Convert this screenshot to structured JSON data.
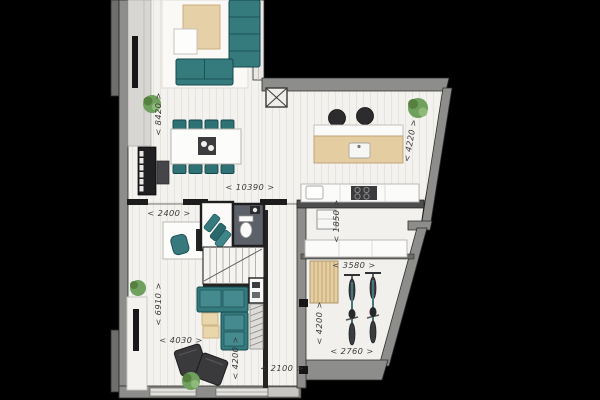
{
  "canvas": {
    "width": 600,
    "height": 400,
    "background": "#000000"
  },
  "palette": {
    "floor": "#f3f2ef",
    "plank_line": "#e6e4df",
    "outer_wall": "#8d8d8b",
    "inner_wall": "#1c1c1c",
    "teal_furniture": "#357a7d",
    "wood": "#e4cda1",
    "rug_beige": "#e6d0a7",
    "dark_furniture": "#3a3a3c",
    "plant_green": "#6fa05e",
    "label_ink": "#3b3b3b"
  },
  "dimensions": [
    {
      "name": "living-room-depth",
      "label": "< 8420 >"
    },
    {
      "name": "overall-width",
      "label": "< 10390 >"
    },
    {
      "name": "hall-width",
      "label": "< 2400 >"
    },
    {
      "name": "kitchen-width",
      "label": "< 4220 >"
    },
    {
      "name": "pantry-depth",
      "label": "< 1850 >"
    },
    {
      "name": "storage-width",
      "label": "< 3580 >"
    },
    {
      "name": "lounge-depth",
      "label": "< 6910 >"
    },
    {
      "name": "lounge-width",
      "label": "< 4030 >"
    },
    {
      "name": "sitting-area-depth",
      "label": "< 4200 >"
    },
    {
      "name": "corridor-width",
      "label": "< 2100 >"
    },
    {
      "name": "storage-depth",
      "label": "< 4200 >"
    },
    {
      "name": "storage-bottom-width",
      "label": "< 2760 >"
    }
  ]
}
